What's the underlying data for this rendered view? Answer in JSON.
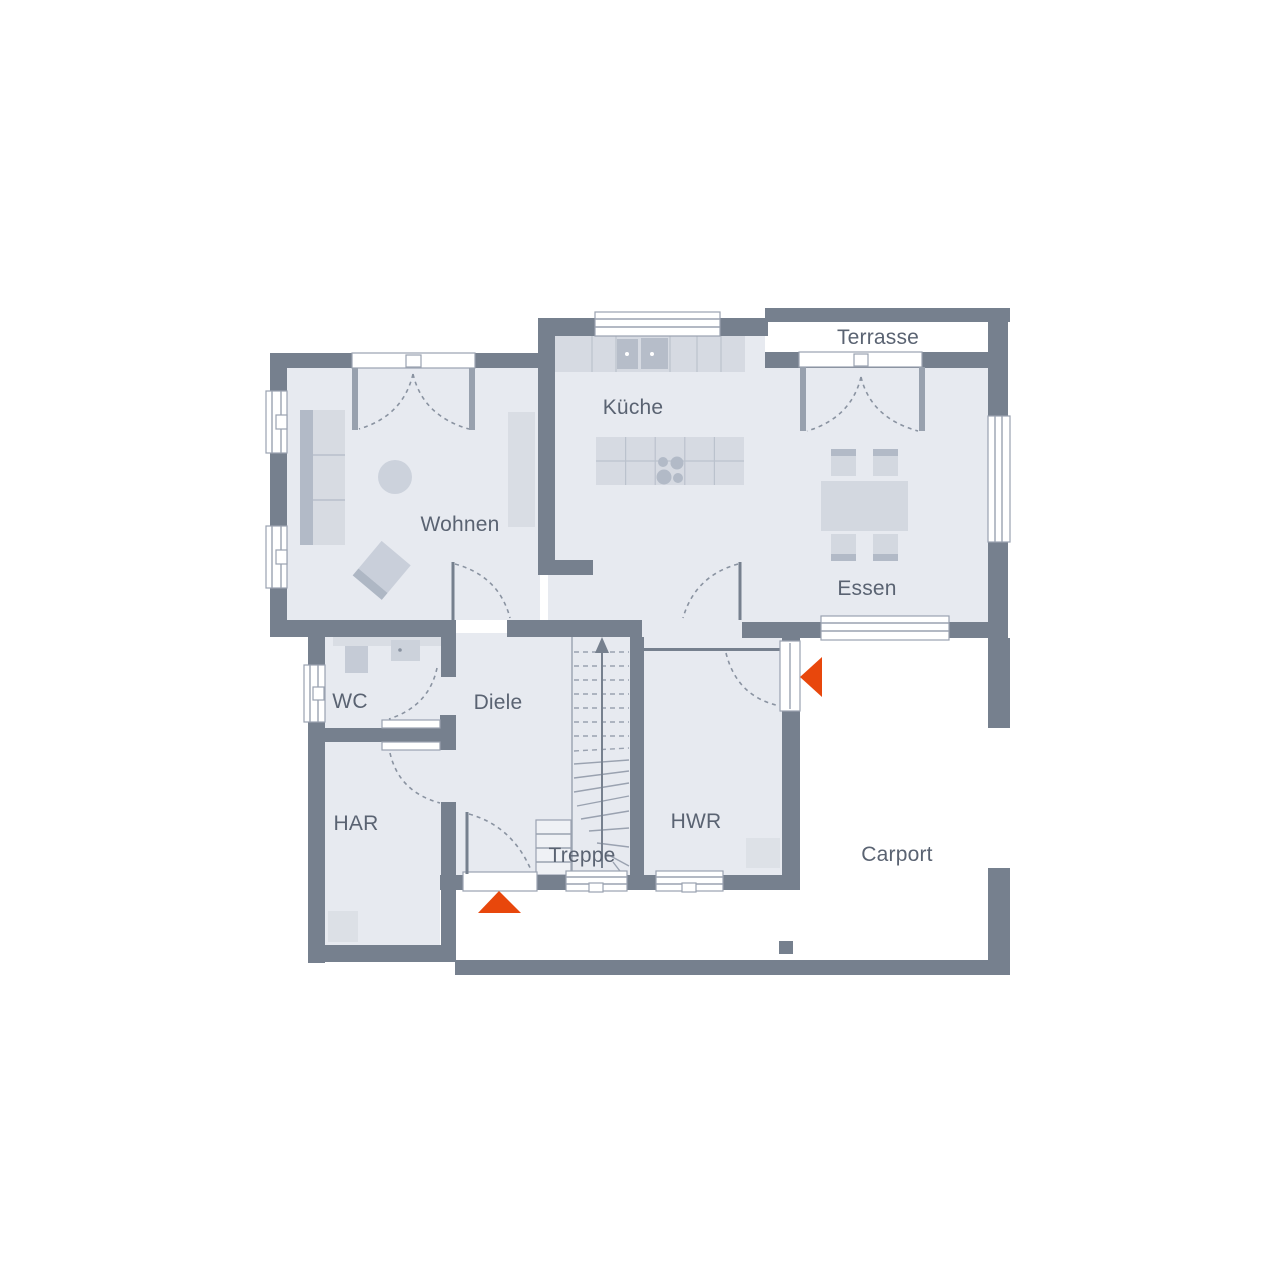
{
  "rooms": {
    "terrasse": "Terrasse",
    "kueche": "Küche",
    "wohnen": "Wohnen",
    "essen": "Essen",
    "wc": "WC",
    "diele": "Diele",
    "har": "HAR",
    "treppe": "Treppe",
    "hwr": "HWR",
    "carport": "Carport"
  },
  "colors": {
    "wall": "#76808E",
    "floor": "#E7EAF0",
    "furniture": "#D6DAE2",
    "furniture_dark": "#B2BAC7",
    "accent": "#E8470C",
    "label_text": "#5A6372"
  },
  "markers": {
    "main_entrance": "entrance-arrow-up",
    "side_entrance": "entrance-arrow-left"
  }
}
